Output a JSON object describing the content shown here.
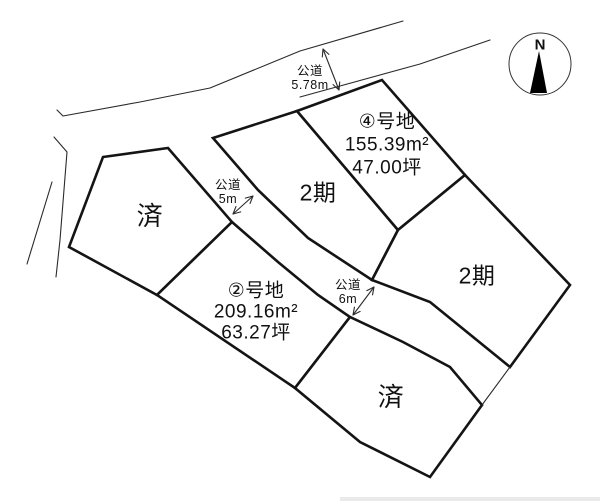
{
  "canvas": {
    "width": 600,
    "height": 501,
    "background": "#ffffff",
    "line_color": "#141414",
    "thin_line_color": "#2a2a2a"
  },
  "compass": {
    "label": "N",
    "cx": 540,
    "cy": 64,
    "r": 31,
    "needle": [
      [
        539,
        51
      ],
      [
        530,
        93
      ],
      [
        547,
        93
      ]
    ]
  },
  "lots": [
    {
      "id": "lot-left-sold",
      "lines": [
        "済"
      ],
      "cx": 150,
      "cy": 216,
      "font": 26,
      "lh": 28,
      "points": [
        [
          103,
          157
        ],
        [
          168,
          148
        ],
        [
          232,
          222
        ],
        [
          157,
          295
        ],
        [
          69,
          247
        ]
      ]
    },
    {
      "id": "lot-middle-phase2",
      "lines": [
        "2期"
      ],
      "cx": 318,
      "cy": 193,
      "font": 23,
      "lh": 25,
      "points": [
        [
          213,
          138
        ],
        [
          297,
          111
        ],
        [
          398,
          230
        ],
        [
          372,
          280
        ],
        [
          308,
          238
        ],
        [
          258,
          190
        ]
      ]
    },
    {
      "id": "lot-4",
      "lines": [
        "④号地",
        "155.39m²",
        "47.00坪"
      ],
      "cx": 387,
      "cy": 145,
      "font": 19,
      "lh": 23,
      "points": [
        [
          297,
          111
        ],
        [
          382,
          80
        ],
        [
          465,
          175
        ],
        [
          398,
          230
        ]
      ]
    },
    {
      "id": "lot-right-phase2",
      "lines": [
        "2期"
      ],
      "cx": 477,
      "cy": 276,
      "font": 23,
      "lh": 25,
      "points": [
        [
          398,
          230
        ],
        [
          465,
          175
        ],
        [
          570,
          285
        ],
        [
          510,
          367
        ],
        [
          430,
          302
        ],
        [
          372,
          280
        ]
      ]
    },
    {
      "id": "lot-2",
      "lines": [
        "②号地",
        "209.16m²",
        "63.27坪"
      ],
      "cx": 256,
      "cy": 312,
      "font": 19,
      "lh": 21,
      "points": [
        [
          232,
          222
        ],
        [
          278,
          262
        ],
        [
          318,
          295
        ],
        [
          350,
          317
        ],
        [
          295,
          388
        ],
        [
          157,
          295
        ]
      ]
    },
    {
      "id": "lot-bottom-sold",
      "lines": [
        "済"
      ],
      "cx": 391,
      "cy": 397,
      "font": 26,
      "lh": 28,
      "points": [
        [
          295,
          388
        ],
        [
          350,
          317
        ],
        [
          403,
          342
        ],
        [
          450,
          367
        ],
        [
          482,
          405
        ],
        [
          430,
          477
        ],
        [
          360,
          442
        ]
      ]
    }
  ],
  "roads": [
    {
      "id": "road-public-578",
      "lines": [
        "公道",
        "5.78m"
      ],
      "cx": 310,
      "cy": 78,
      "font": 12.5,
      "lh": 14,
      "arrow": [
        [
          323,
          49
        ],
        [
          339,
          90
        ]
      ]
    },
    {
      "id": "road-public-5m",
      "lines": [
        "公道",
        "5m"
      ],
      "cx": 228,
      "cy": 192,
      "font": 12.5,
      "lh": 14,
      "arrow": [
        [
          253,
          196
        ],
        [
          233,
          214
        ]
      ]
    },
    {
      "id": "road-public-6m",
      "lines": [
        "公道",
        "6m"
      ],
      "cx": 348,
      "cy": 292,
      "font": 12.5,
      "lh": 14,
      "arrow": [
        [
          374,
          287
        ],
        [
          353,
          315
        ]
      ]
    }
  ],
  "thin_lines": [
    {
      "id": "top-road-north-edge",
      "points": [
        [
          57,
          110
        ],
        [
          63,
          116
        ],
        [
          140,
          102
        ],
        [
          210,
          88
        ],
        [
          300,
          51
        ],
        [
          403,
          21
        ]
      ]
    },
    {
      "id": "top-road-south-edge",
      "points": [
        [
          300,
          97
        ],
        [
          420,
          64
        ],
        [
          490,
          40
        ]
      ]
    },
    {
      "id": "left-road-east-edge",
      "points": [
        [
          54,
          137
        ],
        [
          67,
          152
        ],
        [
          60,
          240
        ],
        [
          56,
          277
        ]
      ]
    },
    {
      "id": "left-road-west-edge",
      "points": [
        [
          52,
          182
        ],
        [
          27,
          264
        ]
      ]
    },
    {
      "id": "road-outlet-southeast",
      "points": [
        [
          510,
          367
        ],
        [
          482,
          405
        ]
      ]
    }
  ],
  "bottom_strip": {
    "x": 340,
    "y": 497,
    "w": 260,
    "h": 4,
    "color": "#eaeaea"
  }
}
